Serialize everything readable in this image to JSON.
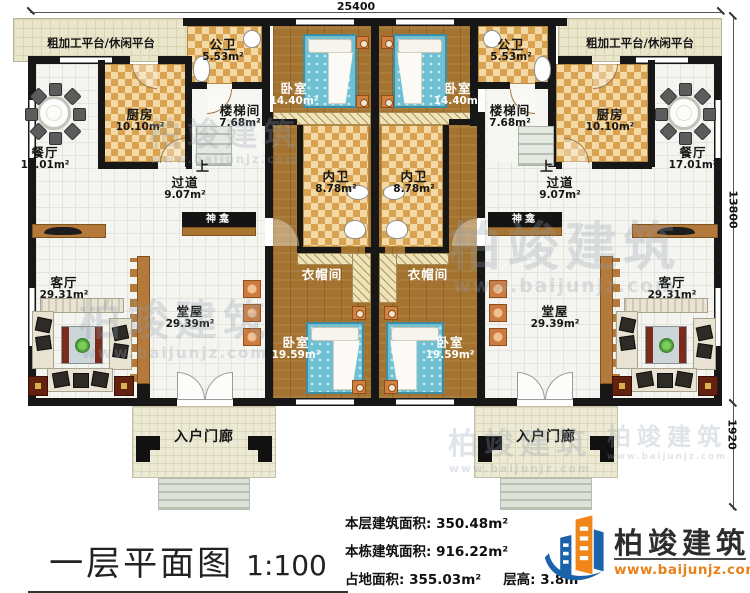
{
  "meta": {
    "type": "floor-plan"
  },
  "dims": {
    "width_top": "25400",
    "height_main": "13800",
    "height_porch": "1920"
  },
  "rooms": {
    "platform_left": {
      "label": "粗加工平台/休闲平台"
    },
    "platform_right": {
      "label": "粗加工平台/休闲平台"
    },
    "public_bath_left": {
      "label": "公卫",
      "area": "5.53m²"
    },
    "public_bath_right": {
      "label": "公卫",
      "area": "5.53m²"
    },
    "bedroom_top_left": {
      "label": "卧室",
      "area": "14.40m²"
    },
    "bedroom_top_right": {
      "label": "卧室",
      "area": "14.40m²"
    },
    "kitchen_left": {
      "label": "厨房",
      "area": "10.10m²"
    },
    "kitchen_right": {
      "label": "厨房",
      "area": "10.10m²"
    },
    "stairwell_left": {
      "label": "楼梯间",
      "area": "7.68m²",
      "direction": "上"
    },
    "stairwell_right": {
      "label": "楼梯间",
      "area": "7.68m²",
      "direction": "上"
    },
    "dining_left": {
      "label": "餐厅",
      "area": "17.01m²"
    },
    "dining_right": {
      "label": "餐厅",
      "area": "17.01m²"
    },
    "corridor_left": {
      "label": "过道",
      "area": "9.07m²"
    },
    "corridor_right": {
      "label": "过道",
      "area": "9.07m²"
    },
    "inner_bath_left": {
      "label": "内卫",
      "area": "8.78m²"
    },
    "inner_bath_right": {
      "label": "内卫",
      "area": "8.78m²"
    },
    "shrine_left": {
      "label": "神龛"
    },
    "shrine_right": {
      "label": "神龛"
    },
    "cloakroom_left": {
      "label": "衣帽间"
    },
    "cloakroom_right": {
      "label": "衣帽间"
    },
    "hall_left": {
      "label": "堂屋",
      "area": "29.39m²"
    },
    "hall_right": {
      "label": "堂屋",
      "area": "29.39m²"
    },
    "living_left": {
      "label": "客厅",
      "area": "29.31m²"
    },
    "living_right": {
      "label": "客厅",
      "area": "29.31m²"
    },
    "bedroom_bottom_left": {
      "label": "卧室",
      "area": "19.59m²"
    },
    "bedroom_bottom_right": {
      "label": "卧室",
      "area": "19.59m²"
    },
    "porch_left": {
      "label": "入户门廊"
    },
    "porch_right": {
      "label": "入户门廊"
    }
  },
  "stats": {
    "floor_area_label": "本层建筑面积:",
    "floor_area_value": "350.48m²",
    "total_area_label": "本栋建筑面积:",
    "total_area_value": "916.22m²",
    "land_area_label": "占地面积:",
    "land_area_value": "355.03m²",
    "height_label": "层高:",
    "height_value": "3.8m"
  },
  "titleblock": {
    "title": "一层平面图",
    "scale": "1:100"
  },
  "brand": {
    "name": "柏竣建筑",
    "website": "www.baijunjz.com"
  },
  "watermark": {
    "text": "柏竣建筑",
    "subtext": "www.baijunjz.com"
  },
  "colors": {
    "wall": "#171717",
    "wood_floor": "#a3732f",
    "tile_floor": "#f4f4f0",
    "checker_tile": "#d8a250",
    "platform": "#e9e6cb",
    "bed": "#6fc0d3",
    "brand_blue": "#1a63ab",
    "brand_orange": "#f08519"
  }
}
